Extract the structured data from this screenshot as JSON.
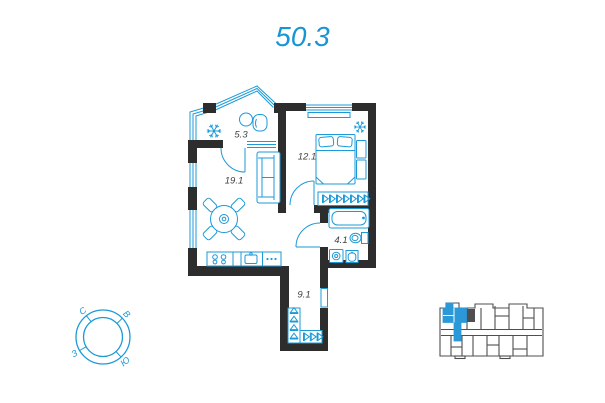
{
  "title": "50.3",
  "plan": {
    "rooms": [
      {
        "id": "balcony",
        "area": "5.3"
      },
      {
        "id": "bedroom",
        "area": "12.1"
      },
      {
        "id": "living-kitchen",
        "area": "19.1"
      },
      {
        "id": "bathroom",
        "area": "4.1"
      },
      {
        "id": "hallway",
        "area": "9.1"
      }
    ],
    "icons": [
      {
        "name": "ac-snowflake-icon",
        "location": "balcony"
      },
      {
        "name": "ac-snowflake-icon",
        "location": "bedroom"
      }
    ]
  },
  "compass": {
    "north_label": "С",
    "east_label": "В",
    "west_label": "З",
    "south_label": "Ю"
  },
  "colors": {
    "accent_blue": "#1b9ad7",
    "title_blue": "#1795d4",
    "wall_dark": "#2d2d2d",
    "minimap_gray": "#4f4f4f",
    "highlight_blue": "#2b98d8"
  }
}
